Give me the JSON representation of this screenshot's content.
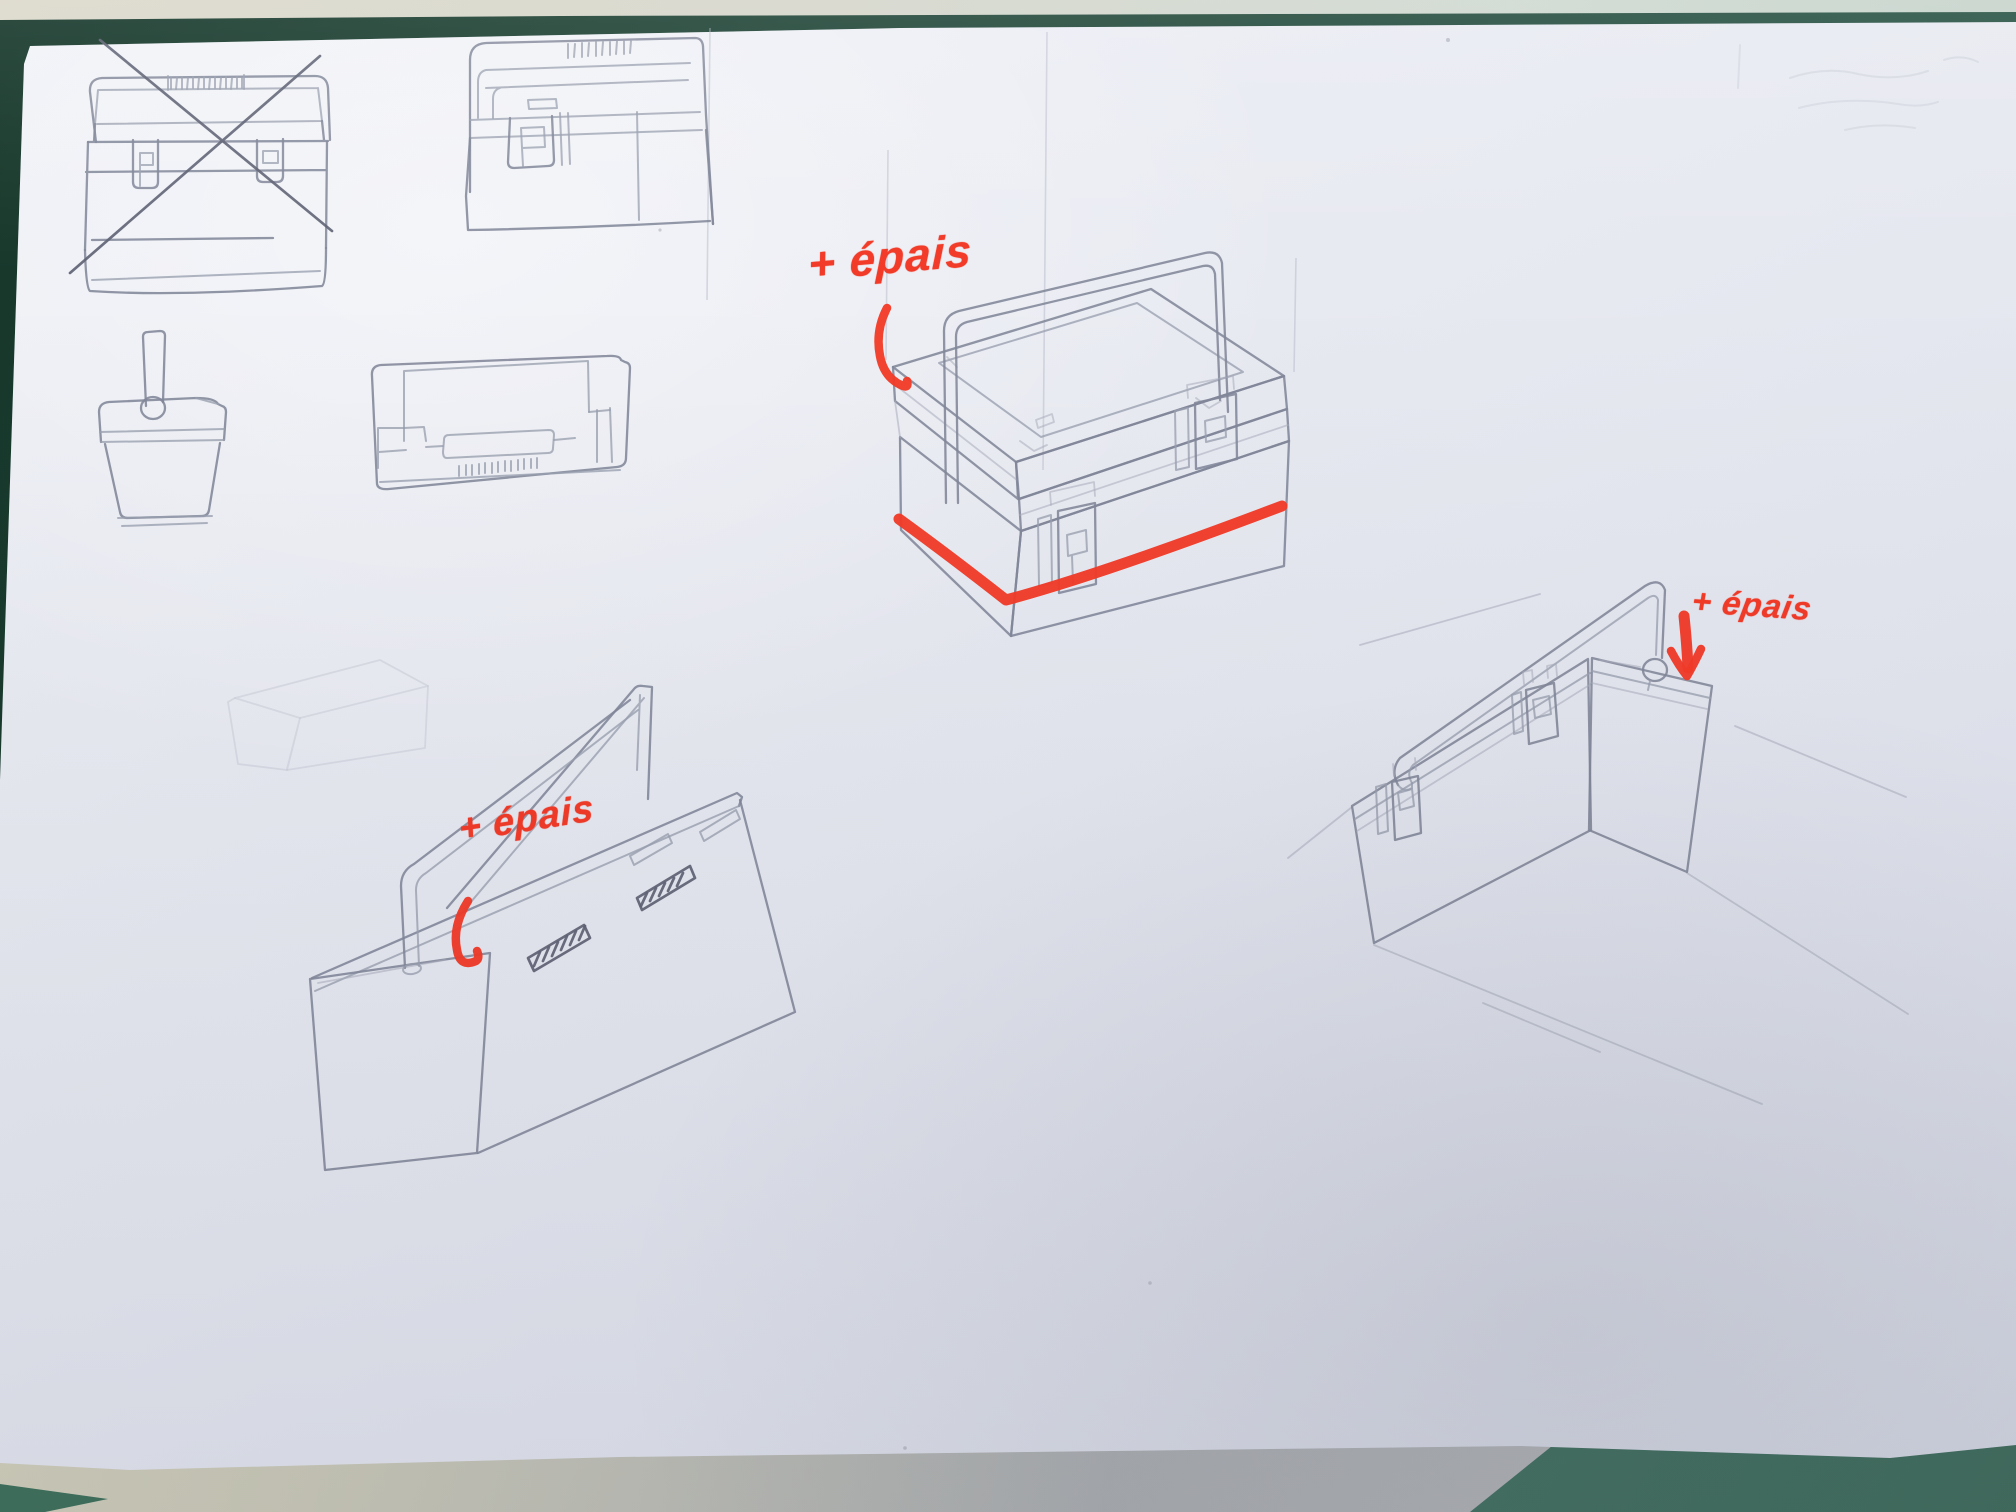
{
  "scene": {
    "paper_color": "#e8e9f0",
    "pencil_color": "#8a8ea0",
    "marker_color": "#f23a28",
    "table_color_top": "#21463a",
    "table_color_bottom_right": "#4b7c6b",
    "under_sheet_color": "#c8c6b6",
    "top_strip_color": "#d6d6cb"
  },
  "annotations": {
    "central": {
      "text": "+ épais"
    },
    "right": {
      "text": "+ épais"
    },
    "bottom_left": {
      "text": "+ épais"
    }
  },
  "sketches": [
    {
      "id": "toolbox-front-view-crossed-out"
    },
    {
      "id": "toolbox-front-view-with-handle"
    },
    {
      "id": "cooler-with-vertical-handle"
    },
    {
      "id": "toolbox-top-view"
    },
    {
      "id": "toolbox-three-quarter-view-red-underline"
    },
    {
      "id": "toolbox-low-angle-view-red-arrow"
    },
    {
      "id": "toolbox-open-lid-view"
    },
    {
      "id": "faint-cuboid-study"
    }
  ]
}
